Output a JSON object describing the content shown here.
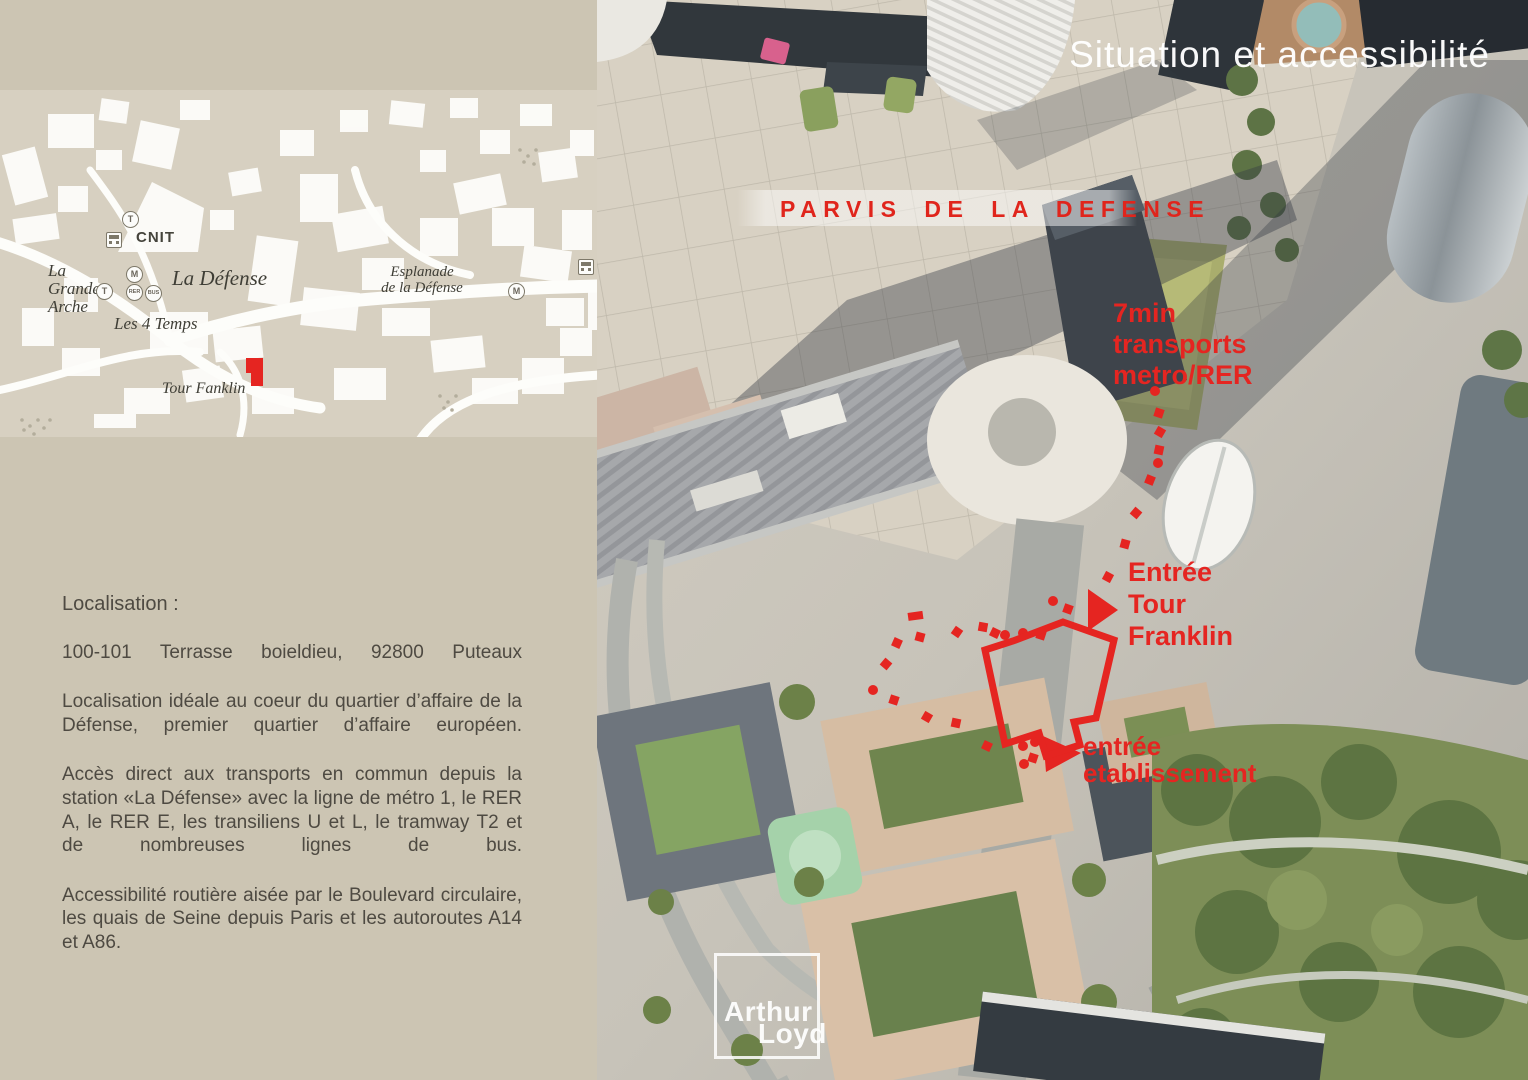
{
  "title": "Situation et accessibilité",
  "map": {
    "labels": {
      "cnit": "CNIT",
      "grande_arche": [
        "La",
        "Grande",
        "Arche"
      ],
      "la_defense": "La Défense",
      "les_4_temps": "Les 4 Temps",
      "esplanade": [
        "Esplanade",
        "de la Défense"
      ],
      "tour_franklin": "Tour Fanklin"
    },
    "transit_icons": {
      "tram": "T",
      "metro": "M",
      "rer": "RER",
      "bus": "BUS"
    }
  },
  "panel": {
    "localisation_heading": "Localisation :",
    "address": "100-101 Terrasse boieldieu, 92800 Puteaux",
    "p1": "Localisation idéale au coeur du quartier d’affaire de la Défense, premier quartier d’affaire européen.",
    "p2": "Accès direct aux transports en commun depuis la station «La Défense» avec la ligne de métro 1, le RER A, le RER E, les transiliens U et L, le tramway T2 et de nombreuses lignes de bus.",
    "p3": "Accessibilité routière aisée par le Boulevard circulaire, les quais de Seine depuis Paris et les autoroutes A14 et A86."
  },
  "overlay": {
    "parvis": "PARVIS DE LA DEFENSE",
    "transit_time": [
      "7min",
      "transports",
      "metro/RER"
    ],
    "entrance_tower": [
      "Entrée",
      "Tour",
      "Franklin"
    ],
    "entrance_establishment": [
      "entrée",
      "etablissement"
    ]
  },
  "logo": [
    "Arthur",
    "Loyd"
  ],
  "colors": {
    "accent_red": "#e52521",
    "panel_beige": "#ccc5b3",
    "map_beige": "#d7d0c1"
  }
}
